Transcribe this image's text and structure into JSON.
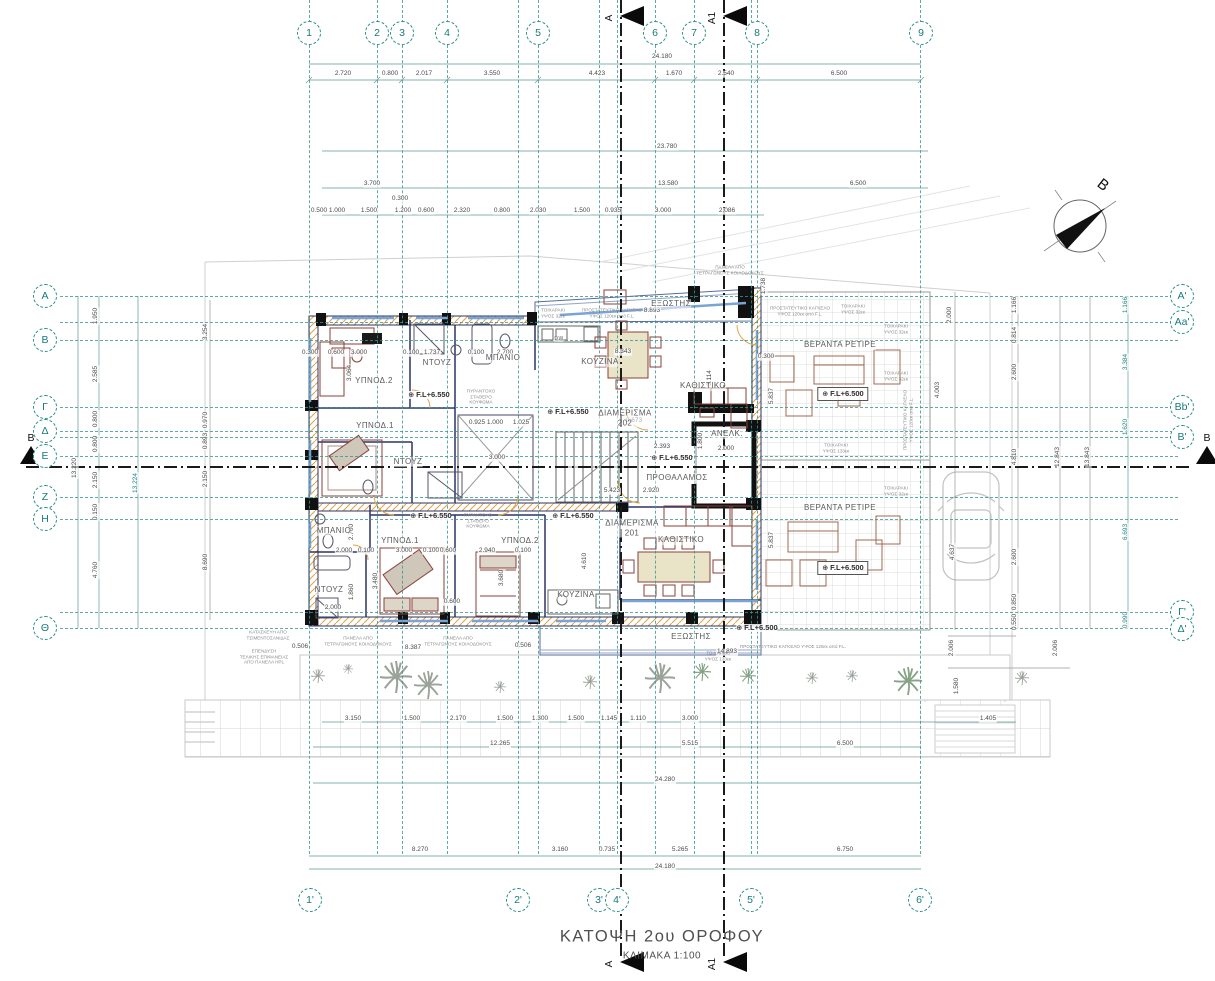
{
  "meta": {
    "title": "ΚΑΤΟΨΗ  2ου ΟΡΟΦΟΥ",
    "scale_label": "ΚΛΙΜΑΚΑ 1:100",
    "level_marker": "⊕",
    "drawing_type": "floor-plan"
  },
  "colors": {
    "grid_teal": "#2a8f8a",
    "wall_navy": "#2b3366",
    "hatch_orange": "#e2a13e",
    "furniture_red": "#8a4038",
    "dim_gray": "#4a4a4a",
    "section_black": "#0a0a0a"
  },
  "grid": {
    "vlines": [
      309,
      377,
      402,
      447,
      518,
      538,
      599,
      617,
      655,
      694,
      751,
      757,
      920
    ],
    "hlines": [
      296,
      322,
      340,
      407,
      431,
      437,
      456,
      497,
      519,
      612,
      628
    ],
    "top": [
      {
        "label": "1",
        "x": 309
      },
      {
        "label": "2",
        "x": 377
      },
      {
        "label": "3",
        "x": 402
      },
      {
        "label": "4",
        "x": 447
      },
      {
        "label": "5",
        "x": 538
      },
      {
        "label": "6",
        "x": 655
      },
      {
        "label": "7",
        "x": 694
      },
      {
        "label": "8",
        "x": 757
      },
      {
        "label": "9",
        "x": 921
      }
    ],
    "bottom": [
      {
        "label": "1'",
        "x": 310
      },
      {
        "label": "2'",
        "x": 518
      },
      {
        "label": "3'",
        "x": 599
      },
      {
        "label": "4'",
        "x": 617
      },
      {
        "label": "5'",
        "x": 751
      },
      {
        "label": "6'",
        "x": 920
      }
    ],
    "left": [
      {
        "label": "Α",
        "y": 296
      },
      {
        "label": "Β",
        "y": 340
      },
      {
        "label": "Γ",
        "y": 407
      },
      {
        "label": "Δ",
        "y": 431
      },
      {
        "label": "Ε",
        "y": 456
      },
      {
        "label": "Ζ",
        "y": 497
      },
      {
        "label": "Η",
        "y": 519
      },
      {
        "label": "Θ",
        "y": 628
      }
    ],
    "right": [
      {
        "label": "Α'",
        "y": 296
      },
      {
        "label": "Αa'",
        "y": 322
      },
      {
        "label": "Bb'",
        "y": 407
      },
      {
        "label": "Β'",
        "y": 437
      },
      {
        "label": "Γ'",
        "y": 612
      },
      {
        "label": "Δ'",
        "y": 629
      }
    ]
  },
  "sections": {
    "vertical": [
      {
        "label": "A",
        "x": 620
      },
      {
        "label": "A1",
        "x": 723
      }
    ],
    "horizontal": [
      {
        "label": "B",
        "y": 466
      }
    ]
  },
  "north": {
    "label": "Β"
  },
  "rooms": [
    {
      "t": "ΕΞΩΣΤΗΣ",
      "x": 671,
      "y": 304
    },
    {
      "t": "ΥΠΝΟΔ.2",
      "x": 374,
      "y": 381
    },
    {
      "t": "ΝΤΟΥΖ",
      "x": 437,
      "y": 363
    },
    {
      "t": "ΜΠΑΝΙΟ",
      "x": 503,
      "y": 358
    },
    {
      "t": "ΚΟΥΖΙΝΑ",
      "x": 600,
      "y": 362
    },
    {
      "t": "ΚΑΘΙΣΤΙΚΟ",
      "x": 703,
      "y": 386
    },
    {
      "t": "ΔΙΑΜΕΡΙΣΜΑ\n202",
      "x": 625,
      "y": 418
    },
    {
      "t": "ΥΠΝΟΔ.1",
      "x": 375,
      "y": 426
    },
    {
      "t": "ΝΤΟΥΖ",
      "x": 408,
      "y": 462
    },
    {
      "t": "ΑΝΕΛΚ.",
      "x": 727,
      "y": 434
    },
    {
      "t": "ΠΡΟΘΑΛΑΜΟΣ",
      "x": 677,
      "y": 478
    },
    {
      "t": "ΒΕΡΑΝΤΑ ΡΕΤΙΡΕ",
      "x": 840,
      "y": 345
    },
    {
      "t": "ΒΕΡΑΝΤΑ ΡΕΤΙΡΕ",
      "x": 840,
      "y": 508
    },
    {
      "t": "ΜΠΑΝΙΟ",
      "x": 334,
      "y": 531
    },
    {
      "t": "ΥΠΝΟΔ.1",
      "x": 400,
      "y": 541
    },
    {
      "t": "ΥΠΝΟΔ.2",
      "x": 520,
      "y": 541
    },
    {
      "t": "ΝΤΟΥΖ",
      "x": 329,
      "y": 590
    },
    {
      "t": "ΚΟΥΖΙΝΑ",
      "x": 576,
      "y": 595
    },
    {
      "t": "ΔΙΑΜΕΡΙΣΜΑ\n201",
      "x": 632,
      "y": 528
    },
    {
      "t": "ΚΑΘΙΣΤΙΚΟ",
      "x": 681,
      "y": 540
    },
    {
      "t": "ΕΞΩΣΤΗΣ",
      "x": 691,
      "y": 637
    },
    {
      "t": "DW",
      "x": 559,
      "y": 339,
      "s": 5
    }
  ],
  "levels": [
    {
      "t": "F.L+6.550",
      "x": 429,
      "y": 395
    },
    {
      "t": "F.L+6.550",
      "x": 568,
      "y": 412
    },
    {
      "t": "F.L+6.550",
      "x": 672,
      "y": 458
    },
    {
      "t": "F.L+6.550",
      "x": 431,
      "y": 516
    },
    {
      "t": "F.L+6.550",
      "x": 573,
      "y": 516
    },
    {
      "t": "F.L+6.500",
      "x": 843,
      "y": 394,
      "b": 1
    },
    {
      "t": "F.L+6.500",
      "x": 843,
      "y": 568,
      "b": 1
    },
    {
      "t": "F.L+6.500",
      "x": 757,
      "y": 628
    }
  ],
  "notes": [
    {
      "t": "ΤΟΙΧΑΡΑΚΙ\nΥΨΟΣ 32εκ",
      "x": 553,
      "y": 313
    },
    {
      "t": "ΠΡΟΣΤΑΤΕΥΤΙΚΟ ΚΑΓΚΕΛΟ\nΥΨΟΣ 120εκ από F.L.",
      "x": 612,
      "y": 313
    },
    {
      "t": "ΠΑΝΕΛΑ ΑΠΟ\nΤΕΤΡΑΓΩΝΟΥΣ ΚΟΙΛΟΔΟΚΟΥΣ",
      "x": 730,
      "y": 270
    },
    {
      "t": "ΠΡΟΣΤΑΤΕΥΤΙΚΟ ΚΑΓΚΕΛΟ\nΥΨΟΣ 120εκ από F.L.",
      "x": 800,
      "y": 311
    },
    {
      "t": "ΤΟΙΧΑΡΑΚΙ\nΥΨΟΣ 32εκ",
      "x": 853,
      "y": 309
    },
    {
      "t": "ΤΟΙΧΑΡΑΚΙ\nΥΨΟΣ 32εκ",
      "x": 896,
      "y": 329
    },
    {
      "t": "ΤΟΙΧΑΡΑΚΙ\nΥΨΟΣ 32εκ",
      "x": 896,
      "y": 376
    },
    {
      "t": "ΤΟΙΧΑΡΑΚΙ\nΥΨΟΣ 133εκ",
      "x": 836,
      "y": 448
    },
    {
      "t": "ΤΟΙΧΑΡΑΚΙ\nΥΨΟΣ 32εκ",
      "x": 896,
      "y": 491
    },
    {
      "t": "ΠΡΟΣΤΑΤΕΥΤΙΚΟ ΚΑΓΚΕΛΟ\nΥΨΟΣ 120εκ από F.L.",
      "x": 908,
      "y": 420,
      "r": 1
    },
    {
      "t": "ΤΟΙΧΑΡΑΚΙ\nΥΨΟΣ 133εκ",
      "x": 718,
      "y": 656
    },
    {
      "t": "ΠΡΟΣΤΑΤΕΥΤΙΚΟ ΚΑΓΚΕΛΟ ΥΨΟΣ 120εκ από F.L.",
      "x": 793,
      "y": 647
    },
    {
      "t": "ΠΥΡΑΝΤΟΧΟ\nΣΤΑΘΕΡΟ\nΚΟΥΦΩΜΑ",
      "x": 481,
      "y": 397
    },
    {
      "t": "ΠΥΡΑΝΤΟΧΟ\nΣΤΑΘΕΡΟ\nΚΟΥΦΩΜΑ",
      "x": 478,
      "y": 521
    },
    {
      "t": "ΚΑΤΑΣΚΕΥΗ ΑΠΟ\nΤΣΙΜΕΝΤΟΣΑΝΙΔΑΣ",
      "x": 268,
      "y": 635
    },
    {
      "t": "ΕΠΕΝΔΥΣΗ\nΤΕΛΙΚΗΣ ΕΠΙΦΑΝΕΙΑΣ\nΑΠΟ ΠΑΝΕΛΑ HPL",
      "x": 264,
      "y": 657
    },
    {
      "t": "ΠΑΝΕΛΑ ΑΠΟ\nΤΕΤΡΑΓΩΝΟΥΣ ΚΟΙΛΟΔΟΚΟΥΣ",
      "x": 358,
      "y": 641
    },
    {
      "t": "ΠΑΝΕΛΑ ΑΠΟ\nΤΕΤΡΑΓΩΝΟΥΣ ΚΟΙΛΟΔΟΚΟΥΣ",
      "x": 458,
      "y": 641
    }
  ],
  "dims": [
    {
      "t": "24.180",
      "x": 662,
      "y": 57
    },
    {
      "t": "2.720",
      "x": 343,
      "y": 74
    },
    {
      "t": "0.800",
      "x": 390,
      "y": 74
    },
    {
      "t": "2.017",
      "x": 424,
      "y": 74
    },
    {
      "t": "3.550",
      "x": 492,
      "y": 74
    },
    {
      "t": "4.423",
      "x": 597,
      "y": 74
    },
    {
      "t": "1.670",
      "x": 674,
      "y": 74
    },
    {
      "t": "2.540",
      "x": 726,
      "y": 74
    },
    {
      "t": "6.500",
      "x": 839,
      "y": 74
    },
    {
      "t": "23.780",
      "x": 667,
      "y": 147
    },
    {
      "t": "3.700",
      "x": 372,
      "y": 184
    },
    {
      "t": "13.580",
      "x": 668,
      "y": 184
    },
    {
      "t": "6.500",
      "x": 858,
      "y": 184
    },
    {
      "t": "0.300",
      "x": 400,
      "y": 199
    },
    {
      "t": "0.500",
      "x": 319,
      "y": 211
    },
    {
      "t": "1.000",
      "x": 337,
      "y": 211
    },
    {
      "t": "1.500",
      "x": 369,
      "y": 211
    },
    {
      "t": "1.200",
      "x": 403,
      "y": 211
    },
    {
      "t": "0.600",
      "x": 426,
      "y": 211
    },
    {
      "t": "2.320",
      "x": 462,
      "y": 211
    },
    {
      "t": "0.800",
      "x": 502,
      "y": 211
    },
    {
      "t": "2.030",
      "x": 538,
      "y": 211
    },
    {
      "t": "1.500",
      "x": 582,
      "y": 211
    },
    {
      "t": "0.935",
      "x": 613,
      "y": 211
    },
    {
      "t": "3.000",
      "x": 663,
      "y": 211
    },
    {
      "t": "2.086",
      "x": 727,
      "y": 211
    },
    {
      "t": "3.150",
      "x": 353,
      "y": 719
    },
    {
      "t": "1.500",
      "x": 412,
      "y": 719
    },
    {
      "t": "2.170",
      "x": 458,
      "y": 719
    },
    {
      "t": "1.500",
      "x": 505,
      "y": 719
    },
    {
      "t": "1.300",
      "x": 540,
      "y": 719
    },
    {
      "t": "1.500",
      "x": 576,
      "y": 719
    },
    {
      "t": "1.145",
      "x": 609,
      "y": 719
    },
    {
      "t": "1.110",
      "x": 638,
      "y": 719
    },
    {
      "t": "3.000",
      "x": 690,
      "y": 719
    },
    {
      "t": "1.405",
      "x": 988,
      "y": 719
    },
    {
      "t": "12.265",
      "x": 500,
      "y": 744
    },
    {
      "t": "5.515",
      "x": 690,
      "y": 744
    },
    {
      "t": "6.500",
      "x": 845,
      "y": 744
    },
    {
      "t": "24.280",
      "x": 665,
      "y": 780
    },
    {
      "t": "8.270",
      "x": 420,
      "y": 850
    },
    {
      "t": "3.160",
      "x": 560,
      "y": 850
    },
    {
      "t": "0.735",
      "x": 607,
      "y": 850
    },
    {
      "t": "5.265",
      "x": 680,
      "y": 850
    },
    {
      "t": "6.750",
      "x": 845,
      "y": 850
    },
    {
      "t": "24.180",
      "x": 665,
      "y": 867
    },
    {
      "t": "1.950",
      "x": 96,
      "y": 316,
      "r": 1
    },
    {
      "t": "2.585",
      "x": 96,
      "y": 374,
      "r": 1
    },
    {
      "t": "0.800",
      "x": 96,
      "y": 419,
      "r": 1
    },
    {
      "t": "0.800",
      "x": 96,
      "y": 444,
      "r": 1
    },
    {
      "t": "2.150",
      "x": 96,
      "y": 480,
      "r": 1
    },
    {
      "t": "0.150",
      "x": 96,
      "y": 512,
      "r": 1
    },
    {
      "t": "4.760",
      "x": 96,
      "y": 570,
      "r": 1
    },
    {
      "t": "13.220",
      "x": 75,
      "y": 468,
      "r": 1
    },
    {
      "t": "13.224",
      "x": 136,
      "y": 483,
      "r": 1,
      "c": 1
    },
    {
      "t": "3.254",
      "x": 206,
      "y": 332,
      "r": 1
    },
    {
      "t": "0.970",
      "x": 206,
      "y": 420,
      "r": 1
    },
    {
      "t": "0.893",
      "x": 206,
      "y": 441,
      "r": 1
    },
    {
      "t": "2.150",
      "x": 206,
      "y": 479,
      "r": 1
    },
    {
      "t": "8.690",
      "x": 206,
      "y": 562,
      "r": 1
    },
    {
      "t": "2.000",
      "x": 950,
      "y": 315,
      "r": 1
    },
    {
      "t": "4.003",
      "x": 938,
      "y": 390,
      "r": 1
    },
    {
      "t": "4.637",
      "x": 953,
      "y": 552,
      "r": 1
    },
    {
      "t": "1.166",
      "x": 1015,
      "y": 305,
      "r": 1
    },
    {
      "t": "0.814",
      "x": 1015,
      "y": 335,
      "r": 1
    },
    {
      "t": "2.600",
      "x": 1015,
      "y": 372,
      "r": 1
    },
    {
      "t": "4.810",
      "x": 1015,
      "y": 457,
      "r": 1
    },
    {
      "t": "2.600",
      "x": 1015,
      "y": 557,
      "r": 1
    },
    {
      "t": "0.850",
      "x": 1015,
      "y": 602,
      "r": 1
    },
    {
      "t": "0.550",
      "x": 1015,
      "y": 622,
      "r": 1
    },
    {
      "t": "12.843",
      "x": 1058,
      "y": 457,
      "r": 1
    },
    {
      "t": "13.843",
      "x": 1088,
      "y": 457,
      "r": 1
    },
    {
      "t": "1.166",
      "x": 1126,
      "y": 305,
      "r": 1,
      "c": 1
    },
    {
      "t": "3.384",
      "x": 1126,
      "y": 362,
      "r": 1,
      "c": 1
    },
    {
      "t": "1.620",
      "x": 1126,
      "y": 427,
      "r": 1,
      "c": 1
    },
    {
      "t": "6.693",
      "x": 1126,
      "y": 532,
      "r": 1,
      "c": 1
    },
    {
      "t": "0.990",
      "x": 1126,
      "y": 620,
      "r": 1,
      "c": 1
    },
    {
      "t": "0.300",
      "x": 310,
      "y": 353
    },
    {
      "t": "0.600",
      "x": 336,
      "y": 353
    },
    {
      "t": "3.000",
      "x": 359,
      "y": 353
    },
    {
      "t": "0.100",
      "x": 411,
      "y": 353
    },
    {
      "t": "1.737",
      "x": 432,
      "y": 353
    },
    {
      "t": "0.100",
      "x": 476,
      "y": 353
    },
    {
      "t": "2.700",
      "x": 505,
      "y": 353
    },
    {
      "t": "3.064",
      "x": 350,
      "y": 373,
      "r": 1
    },
    {
      "t": "8.343",
      "x": 623,
      "y": 352
    },
    {
      "t": "3.114",
      "x": 710,
      "y": 378,
      "r": 1
    },
    {
      "t": "0.300",
      "x": 766,
      "y": 357
    },
    {
      "t": "5.837",
      "x": 772,
      "y": 396,
      "r": 1
    },
    {
      "t": "1.738",
      "x": 764,
      "y": 286,
      "r": 1
    },
    {
      "t": "8.893",
      "x": 652,
      "y": 311
    },
    {
      "t": "0.673",
      "x": 634,
      "y": 421
    },
    {
      "t": "2.393",
      "x": 662,
      "y": 447
    },
    {
      "t": "1.800",
      "x": 701,
      "y": 441,
      "r": 1
    },
    {
      "t": "2.000",
      "x": 726,
      "y": 449
    },
    {
      "t": "0.925",
      "x": 477,
      "y": 423
    },
    {
      "t": "1.000",
      "x": 495,
      "y": 423
    },
    {
      "t": "1.025",
      "x": 521,
      "y": 423
    },
    {
      "t": "3.000",
      "x": 497,
      "y": 458
    },
    {
      "t": "5.423",
      "x": 612,
      "y": 491
    },
    {
      "t": "2.920",
      "x": 651,
      "y": 491
    },
    {
      "t": "2.000",
      "x": 344,
      "y": 551
    },
    {
      "t": "0.100",
      "x": 366,
      "y": 551
    },
    {
      "t": "3.000",
      "x": 404,
      "y": 551
    },
    {
      "t": "0.100",
      "x": 431,
      "y": 551
    },
    {
      "t": "0.600",
      "x": 448,
      "y": 551
    },
    {
      "t": "2.940",
      "x": 487,
      "y": 551
    },
    {
      "t": "0.100",
      "x": 523,
      "y": 551
    },
    {
      "t": "2.700",
      "x": 352,
      "y": 532,
      "r": 1
    },
    {
      "t": "3.480",
      "x": 376,
      "y": 581,
      "r": 1
    },
    {
      "t": "3.680",
      "x": 502,
      "y": 578,
      "r": 1
    },
    {
      "t": "0.600",
      "x": 452,
      "y": 602
    },
    {
      "t": "2.000",
      "x": 333,
      "y": 608
    },
    {
      "t": "1.860",
      "x": 352,
      "y": 592,
      "r": 1
    },
    {
      "t": "4.610",
      "x": 585,
      "y": 561,
      "r": 1
    },
    {
      "t": "8.387",
      "x": 413,
      "y": 648
    },
    {
      "t": "0.506",
      "x": 300,
      "y": 647
    },
    {
      "t": "0.506",
      "x": 523,
      "y": 646
    },
    {
      "t": "14.893",
      "x": 727,
      "y": 652
    },
    {
      "t": "5.837",
      "x": 772,
      "y": 540,
      "r": 1
    },
    {
      "t": "2.006",
      "x": 952,
      "y": 648,
      "r": 1
    },
    {
      "t": "1.580",
      "x": 957,
      "y": 686,
      "r": 1
    },
    {
      "t": "2.006",
      "x": 1056,
      "y": 648,
      "r": 1
    }
  ]
}
